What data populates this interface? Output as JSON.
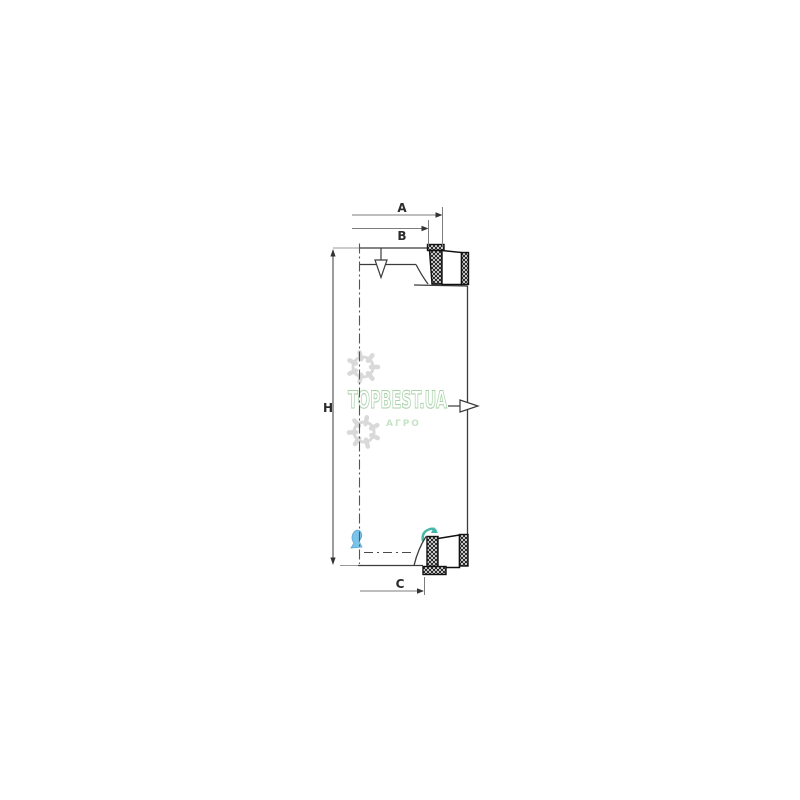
{
  "page": {
    "background": "#ffffff"
  },
  "drawing": {
    "dimension_labels": {
      "A": "A",
      "B": "B",
      "C": "C",
      "H": "H"
    },
    "line_color": "#3b3b3b",
    "dim_line_color": "#7d7d7d",
    "label_color": "#2b2b2b",
    "hatch_color": "#1c1c1c",
    "icons": {
      "inlet": "air-inlet-funnel-arrow-icon",
      "outlet": "air-outlet-right-arrow-icon"
    }
  },
  "watermark": {
    "brand": "TOPBEST.UA",
    "subtitle": "АГРО",
    "brand_color": "#a9d2a9",
    "subtitle_color": "#c6e3c6",
    "gear_color": "#d9d9d9",
    "blue_arrow_color": "#7cc3e8",
    "teal_arrow_color": "#46b6aa"
  }
}
